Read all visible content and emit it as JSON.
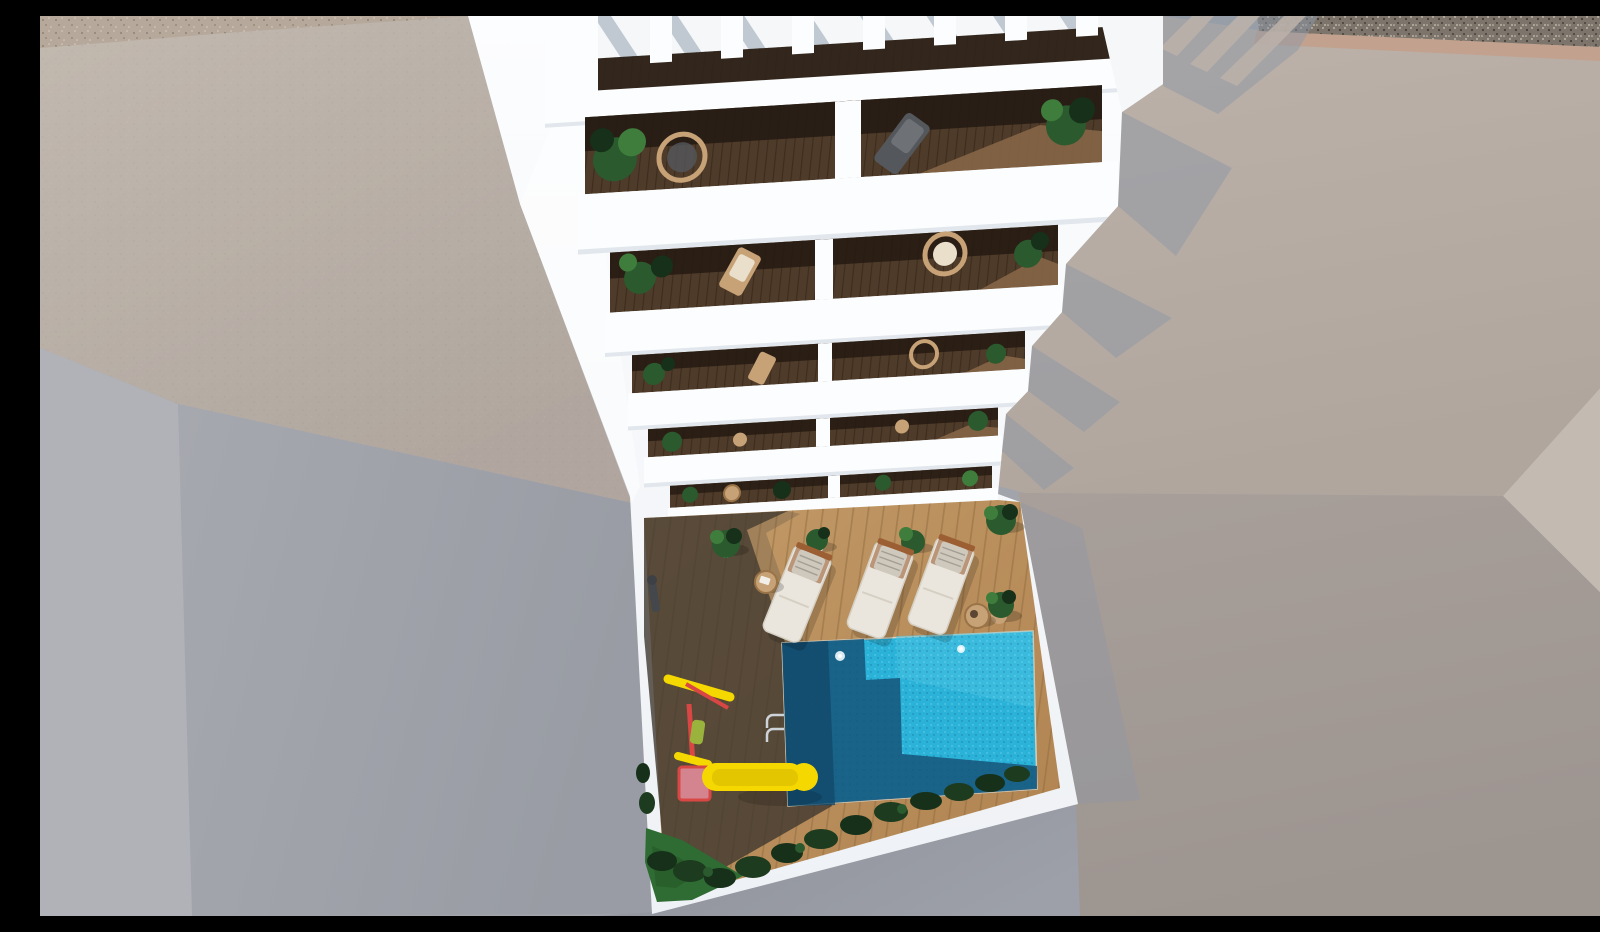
{
  "scene": {
    "title": "Aerial 3D architectural render of a white apartment building with balconies, rooftop pergola and pool courtyard",
    "description": "Top-down render: white residential building with a slatted rooftop pergola, five tiers of balconies with dark wood decks, tropical plants and rattan chairs, descending to a courtyard with a wooden sun deck, three cream sun loungers, potted plants, a turquoise swimming pool with ladder, a children's playground with yellow slide and swing, dark green hedges, surrounded by gray and beige neighboring rooftops with a gravel strip in the top-right corner.",
    "type": "architectural-render",
    "objects": {
      "balcony_floors": 5,
      "balconies_per_floor": 2,
      "pergola_slats": 7,
      "sun_loungers": 3,
      "side_tables": 2,
      "potted_plants": 5,
      "pools": 1,
      "slides": 1,
      "swings": 1,
      "pool_ladders": 1,
      "outdoor_showers": 1
    }
  },
  "colors": {
    "bgGray": "#a2a4ab",
    "leftLight": "#b0b2b8",
    "leftShadowA": "#a6a8af",
    "leftShadowB": "#999ca4",
    "beigeTop": "#c3bbb2",
    "beigeBottom": "#afa69f",
    "speckleBase": "#b6a99b",
    "speckleDark": "#8d8275",
    "speckleLight": "#d8cdbd",
    "gravelBase": "#7d756c",
    "gravelDark": "#46403a",
    "gravelLight": "#cfc5b6",
    "tanBand": "#c2a28e",
    "roofTop": "#bcb2aa",
    "roofBottom": "#b0a69e",
    "facetRight": "#c3bab2",
    "mauveTop": "#a89f9a",
    "mauveBottom": "#9d9590",
    "bottomGrayA": "#8e919a",
    "bottomGrayB": "#9da0a8",
    "white": "#fcfdfe",
    "whiteLow": "#eef1f5",
    "whitePanel": "#f5f7f9",
    "whiteShade": "#e7ebf0",
    "underShade": "#dbe1e8",
    "slatStripe": "#b3bdc8",
    "shadowBlue": "#8e97a5",
    "woodBase": "#4f3b29",
    "woodBand": "#33271d",
    "woodLine": "#2e2117",
    "woodLit": "#8a6848",
    "interiorDark": "#241a12",
    "deckSunA": "#c29a68",
    "deckSunB": "#b08350",
    "deckLine": "#8f6a3f",
    "deckShadow": "#3f372e",
    "penumbra": "#6b5b47",
    "poolBright": "#2bb2d8",
    "poolWash": "#49c4e4",
    "poolSpark": "#7fdcf0",
    "poolDark": "#17567c",
    "poolDeep": "#114a6b",
    "poolEdge": "#d8cfba",
    "plantDark": "#16301a",
    "plantMid": "#2a5a2d",
    "plantLight": "#3f7d3d",
    "rattan": "#c7a277",
    "rattanDark": "#9a7347",
    "cushion": "#e9dfcb",
    "chairDark": "#54575b",
    "chairDarkHi": "#6e7276",
    "lounger": "#eae6de",
    "loungerEdge": "#d6d0c4",
    "pillow": "#cfc9bd",
    "pillowStripe": "#a39e93",
    "woodFrame": "#9b5f33",
    "yellow": "#f4d800",
    "yellowDark": "#d6b700",
    "red": "#d84743",
    "pink": "#d4848f",
    "seatGreen": "#9ab33c",
    "grass": "#2e6c33",
    "grassDark": "#245726",
    "chrome": "#cdd3d8",
    "glint": "#eefbff",
    "showerDark": "#44484c"
  }
}
